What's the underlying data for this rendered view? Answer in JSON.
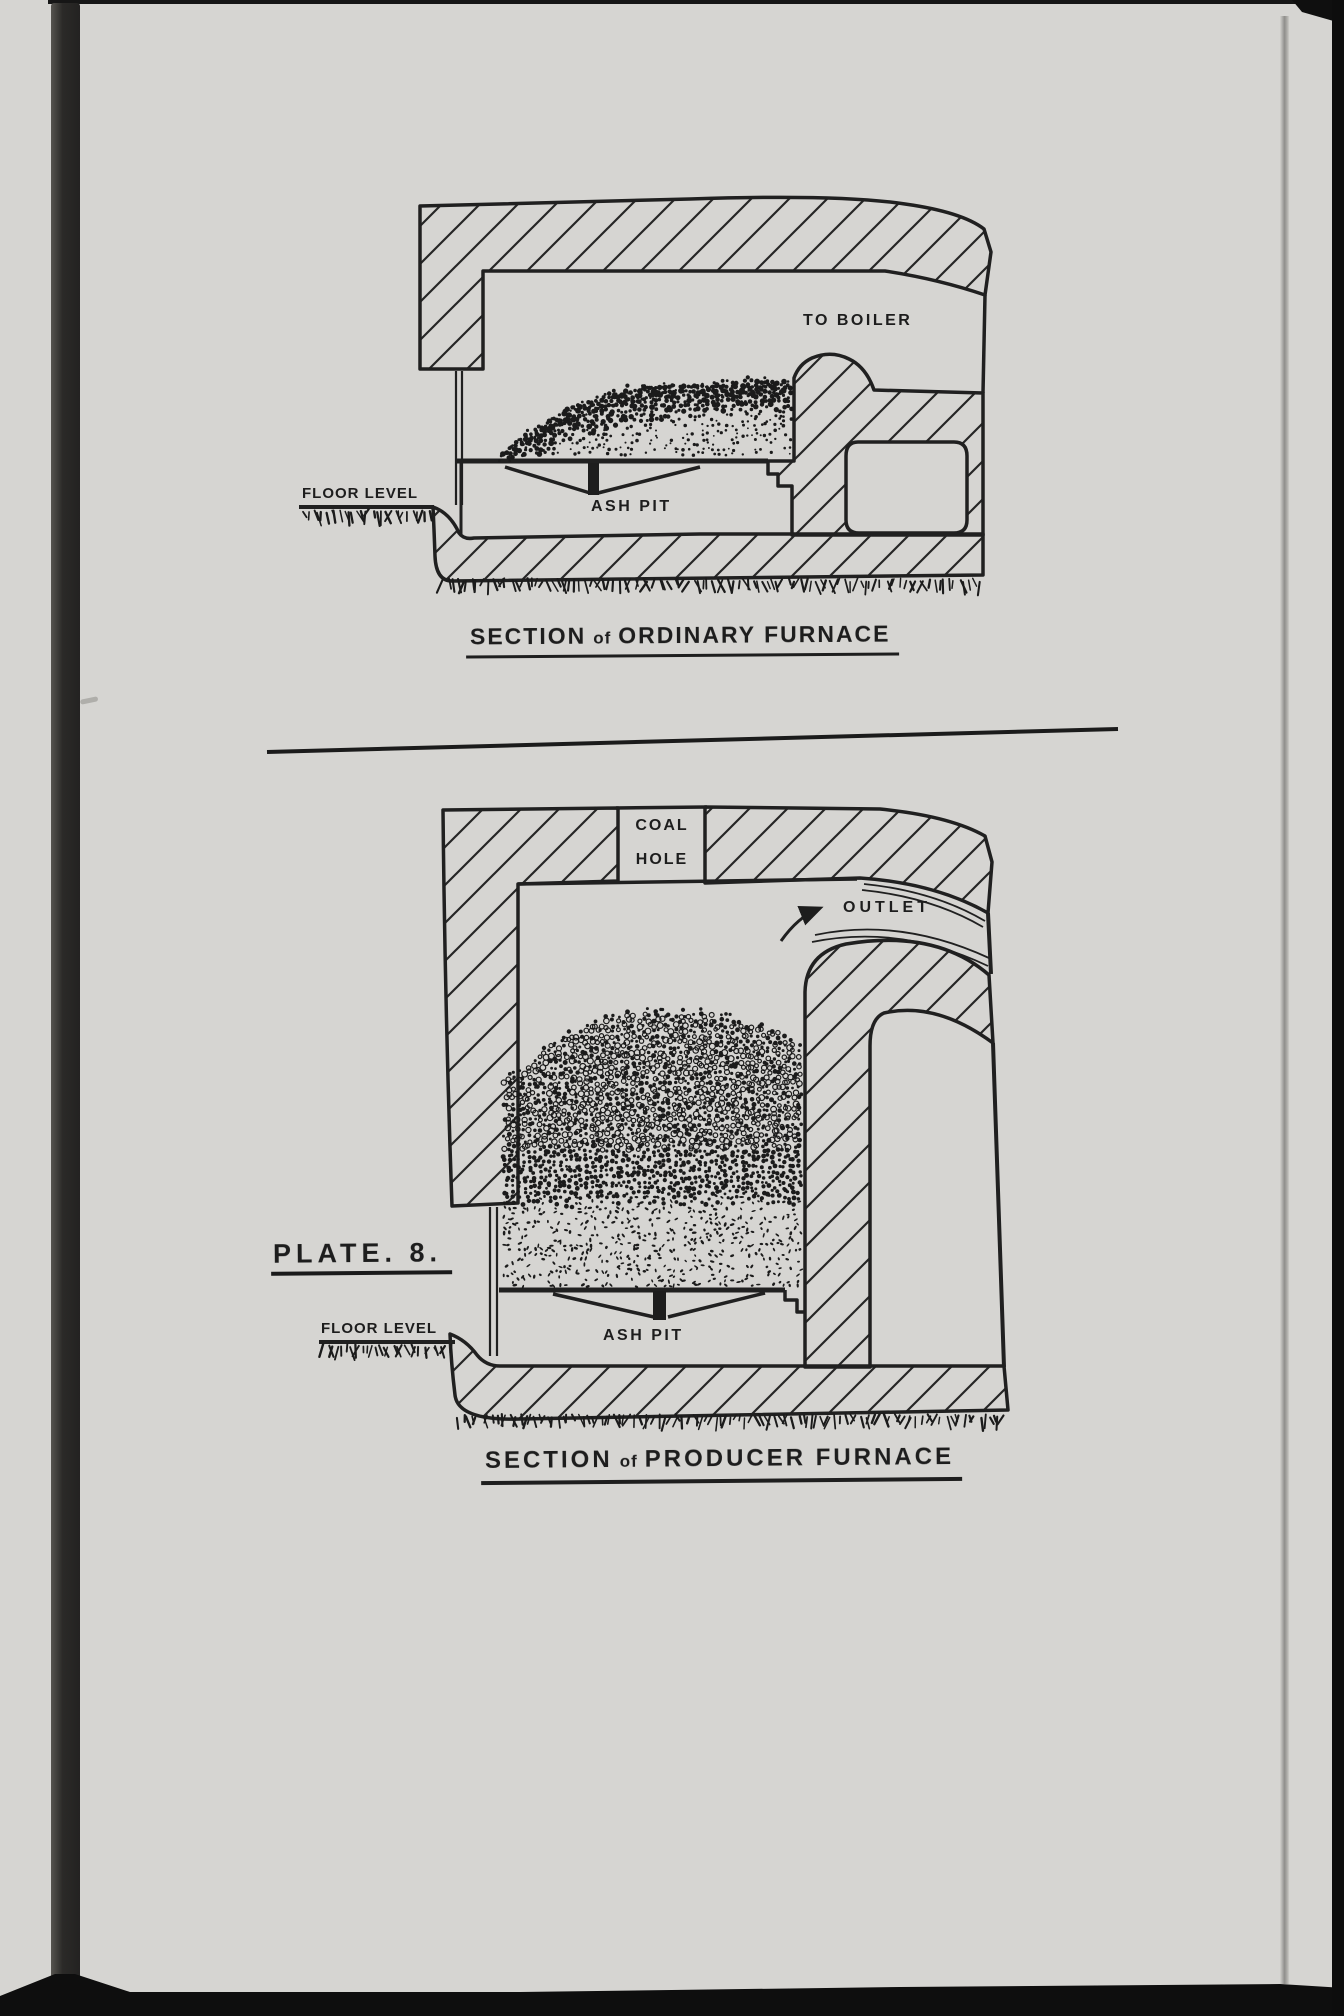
{
  "plate": {
    "label": "PLATE. 8."
  },
  "ordinary_furnace": {
    "title": {
      "lead": "SECTION",
      "connector": "of",
      "rest": "ORDINARY FURNACE"
    },
    "labels": {
      "to_boiler": "TO BOILER",
      "floor_level": "FLOOR LEVEL",
      "ash_pit": "ASH PIT"
    }
  },
  "producer_furnace": {
    "title": {
      "lead": "SECTION",
      "connector": "of",
      "rest": "PRODUCER FURNACE"
    },
    "labels": {
      "coal_hole_top": "COAL",
      "coal_hole_bottom": "HOLE",
      "outlet": "OUTLET",
      "floor_level": "FLOOR LEVEL",
      "ash_pit": "ASH PIT"
    }
  },
  "colors": {
    "ink": "#1d1d1d",
    "paper": "#e9e8e4",
    "scan_border": "#0e0e0e"
  }
}
